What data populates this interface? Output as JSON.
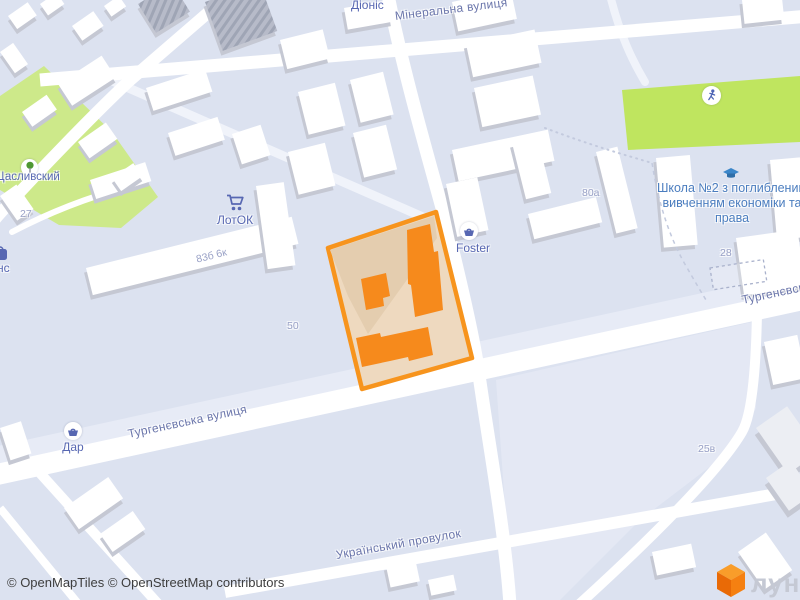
{
  "streets": {
    "mineralna": "Мінеральна вулиця",
    "turhenievska": "Тургенєвська вулиця",
    "turhenievska_right": "Тургенєвська вулиця",
    "ukrainskyi": "Український провулок"
  },
  "pois": {
    "dionis": "Діоніс",
    "shchaslyvskyi": "Щасливский",
    "lotok": "ЛотОК",
    "foster": "Foster",
    "dar": "Дар",
    "school": "Школа №2 з поглибленим вивченням економіки та права",
    "partial_left": "нс"
  },
  "house_numbers": {
    "n27": "27",
    "n836": "83б 6к",
    "n50": "50",
    "n80a": "80а",
    "n28": "28",
    "n25v": "25в"
  },
  "attribution": {
    "text": "© OpenMapTiles © OpenStreetMap contributors"
  },
  "logo": {
    "text": "лун"
  },
  "colors": {
    "background": "#dce2f0",
    "road": "#ffffff",
    "park_green": "#cde98a",
    "field_green": "#bfe55f",
    "parcel_fill": "#eed9bf",
    "parcel_border": "#f7941d",
    "parcel_buildings": "#f68a1c",
    "building_top": "#ffffff",
    "building_side": "#c5c8d3",
    "poi_blue": "#5767b2",
    "school_blue": "#4b7dbf",
    "street_label": "#6b76ab",
    "logo_orange": "#f58011"
  }
}
